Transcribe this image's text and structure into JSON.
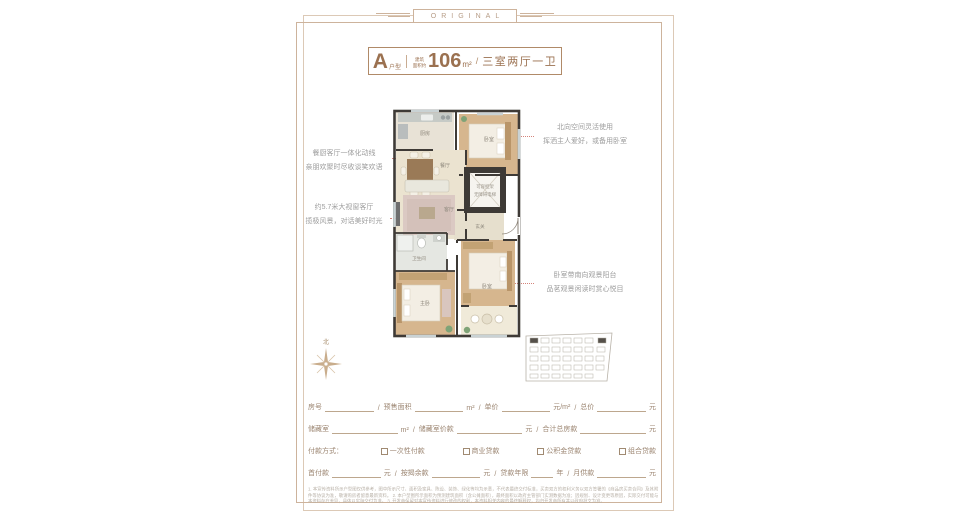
{
  "banner": {
    "label": "ORIGINAL"
  },
  "title": {
    "type_letter": "A",
    "type_word": "户型",
    "area_small_1": "建筑",
    "area_small_2": "面积约",
    "area_value": "106",
    "area_unit": "m²",
    "slash": "/",
    "layout": "三室两厅一卫"
  },
  "annotations": {
    "left1": {
      "line1": "餐厨客厅一体化动线",
      "line2": "亲朋欢聚时尽收谈笑欢语"
    },
    "left2": {
      "line1": "约5.7米大视窗客厅",
      "line2": "揽极风景，对话美好时光"
    },
    "right1": {
      "line1": "北向空间灵活使用",
      "line2": "挥洒主人爱好，或备用卧室"
    },
    "right2": {
      "line1": "卧室带南向观景阳台",
      "line2": "品茗观景闲读时赏心悦目"
    }
  },
  "floorplan": {
    "kitchen": "厨房",
    "bedroom_north": "卧室",
    "dining": "餐厅",
    "living": "客厅",
    "bathroom": "卫生间",
    "master_bedroom": "主卧",
    "bedroom_south": "卧室",
    "entry": "玄关",
    "elevator_line1": "可容担架",
    "elevator_line2": "无障碍电梯"
  },
  "compass": {
    "north": "北"
  },
  "form": {
    "row1": {
      "l1": "房号",
      "s1": "/",
      "l2": "预售面积",
      "u2": "m²",
      "s2": "/",
      "l3": "单价",
      "u3": "元/m²",
      "s3": "/",
      "l4": "总价",
      "u4": "元"
    },
    "row2": {
      "l1": "储藏室",
      "u1": "m²",
      "s1": "/",
      "l2": "储藏室价款",
      "u2": "元",
      "s2": "/",
      "l3": "合计总房款",
      "u3": "元"
    },
    "row3": {
      "label": "付款方式：",
      "opt1": "一次性付款",
      "opt2": "商业贷款",
      "opt3": "公积金贷款",
      "opt4": "组合贷款"
    },
    "row4": {
      "l1": "首付款",
      "u1": "元",
      "s1": "/",
      "l2": "按揭余款",
      "u2": "元",
      "s2": "/",
      "l3": "贷款年限",
      "u3": "年",
      "s3": "/",
      "l4": "月供款",
      "u4": "元"
    }
  },
  "disclaimer": {
    "line1": "1. 本宣传资料所示户型图仅供参考，图中所示尺寸、面积及家具、陈设、装饰、绿化等均为示意，不代表最终交付标准，买卖双方的权利义务以双方签署的《商品房买卖合同》及其附件等协议为准，敬请购房者留意最新资料。",
    "2_note": "",
    "line2": "2. 本户型图所示面积为预测建筑面积（含公摊面积），最终面积以政府主管部门实测数据为准；因规划、设计变更等原因，实际交付可能与本资料存在差异，具体以实际交付为准。",
    "line3": "3. 开发商保留对本宣传资料进行修改的权利，本资料相关内容的最终解释权，均归开发商所有并以政府批文为准。"
  }
}
